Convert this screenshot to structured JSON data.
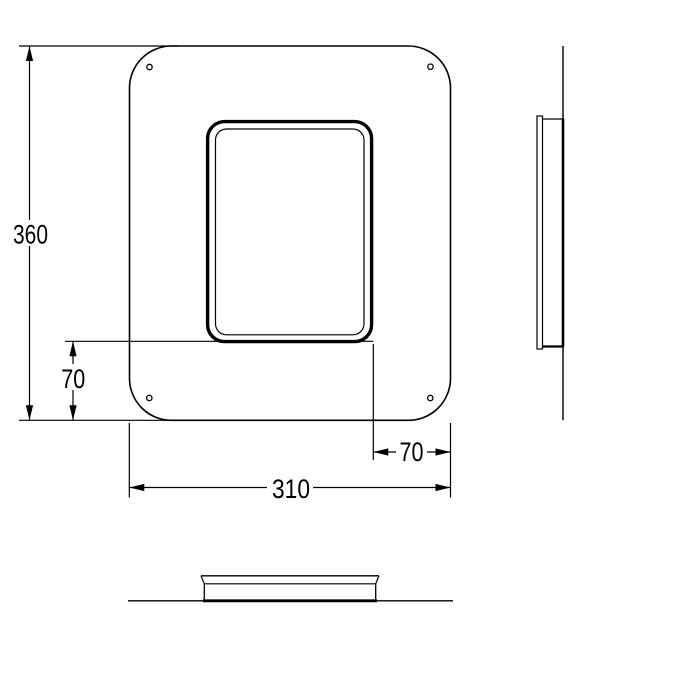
{
  "drawing": {
    "kind": "technical-drawing",
    "views": {
      "front": "front view of mounting frame with rounded corners, inner bezel opening and four corner screw holes",
      "side": "side profile view",
      "bottom": "bottom profile view"
    },
    "dimensions": {
      "overall_height": "360",
      "offset_bottom": "70",
      "offset_right": "70",
      "overall_width": "310"
    },
    "colors": {
      "line": "#000000",
      "background": "#ffffff"
    }
  }
}
